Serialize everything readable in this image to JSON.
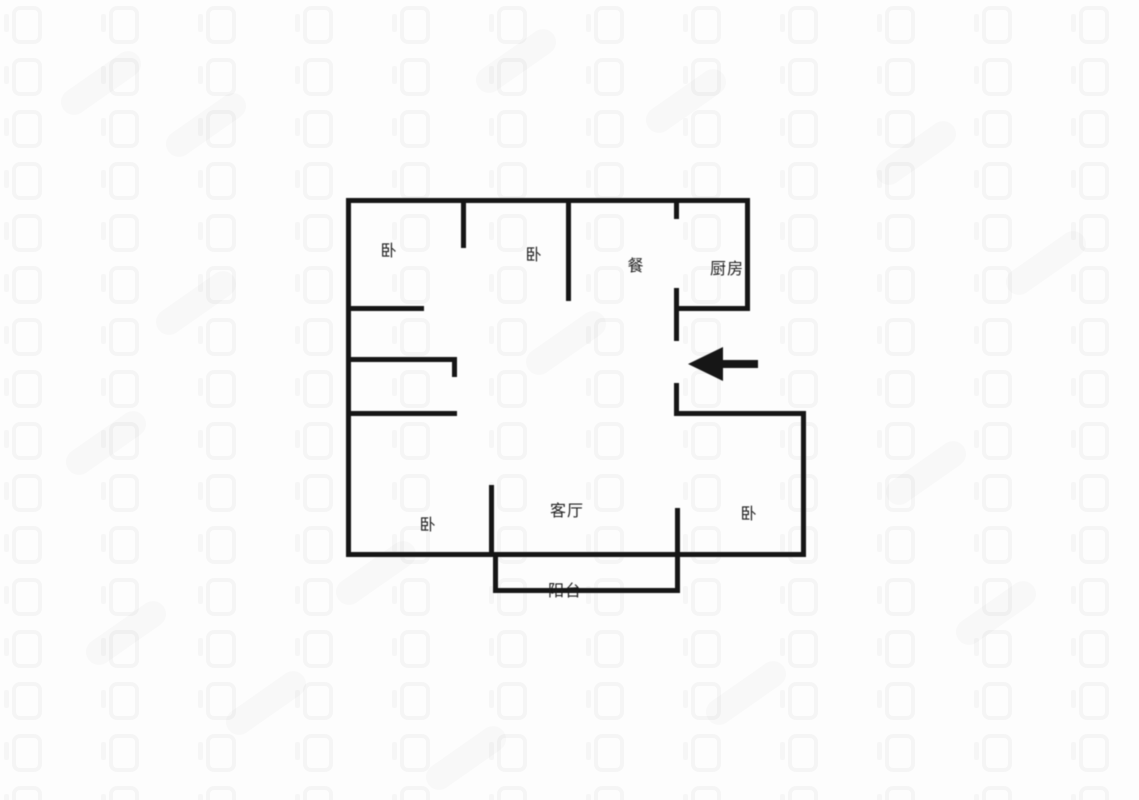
{
  "floorplan": {
    "wall_color": "#161616",
    "rooms": [
      {
        "name": "bedroom-1",
        "label": "卧",
        "x": 389,
        "y": 249
      },
      {
        "name": "bedroom-2",
        "label": "卧",
        "x": 534,
        "y": 253
      },
      {
        "name": "dining",
        "label": "餐",
        "x": 636,
        "y": 264
      },
      {
        "name": "kitchen",
        "label": "厨房",
        "x": 727,
        "y": 267
      },
      {
        "name": "bedroom-3",
        "label": "卧",
        "x": 428,
        "y": 523
      },
      {
        "name": "living-room",
        "label": "客厅",
        "x": 567,
        "y": 509
      },
      {
        "name": "bedroom-4",
        "label": "卧",
        "x": 749,
        "y": 512
      },
      {
        "name": "balcony",
        "label": "阳台",
        "x": 565,
        "y": 589
      }
    ],
    "walls": [
      {
        "name": "outer-top",
        "x": 346,
        "y": 198,
        "w": 404,
        "h": 5
      },
      {
        "name": "outer-left",
        "x": 346,
        "y": 198,
        "w": 5,
        "h": 359
      },
      {
        "name": "outer-bottom",
        "x": 346,
        "y": 552,
        "w": 460,
        "h": 5
      },
      {
        "name": "outer-right-lower",
        "x": 801,
        "y": 411,
        "w": 5,
        "h": 146
      },
      {
        "name": "bedroom-4-top",
        "x": 674,
        "y": 411,
        "w": 132,
        "h": 5
      },
      {
        "name": "outer-right-upper",
        "x": 745,
        "y": 198,
        "w": 5,
        "h": 113
      },
      {
        "name": "kitchen-bottom",
        "x": 674,
        "y": 306,
        "w": 76,
        "h": 5
      },
      {
        "name": "kitchen-left-stub",
        "x": 674,
        "y": 198,
        "w": 5,
        "h": 21
      },
      {
        "name": "kitchen-left-mid",
        "x": 674,
        "y": 288,
        "w": 5,
        "h": 53
      },
      {
        "name": "entry-side",
        "x": 674,
        "y": 383,
        "w": 5,
        "h": 33
      },
      {
        "name": "bed1-bed2-partition",
        "x": 461,
        "y": 198,
        "w": 5,
        "h": 50
      },
      {
        "name": "bed2-dining-partition",
        "x": 566,
        "y": 198,
        "w": 5,
        "h": 103
      },
      {
        "name": "bed1-bottom",
        "x": 346,
        "y": 306,
        "w": 78,
        "h": 5
      },
      {
        "name": "hall-upper",
        "x": 346,
        "y": 357,
        "w": 111,
        "h": 5
      },
      {
        "name": "hall-stub",
        "x": 452,
        "y": 357,
        "w": 5,
        "h": 20
      },
      {
        "name": "hall-lower",
        "x": 346,
        "y": 411,
        "w": 111,
        "h": 5
      },
      {
        "name": "bed3-living-partition",
        "x": 489,
        "y": 485,
        "w": 5,
        "h": 72
      },
      {
        "name": "living-bed4-partition",
        "x": 675,
        "y": 508,
        "w": 5,
        "h": 85
      },
      {
        "name": "balcony-left",
        "x": 493,
        "y": 552,
        "w": 5,
        "h": 41
      },
      {
        "name": "balcony-bottom",
        "x": 493,
        "y": 588,
        "w": 186,
        "h": 5
      }
    ],
    "entrance_arrow": {
      "direction": "left",
      "points": "688,364 723,347 723,360 758,360 758,368 723,368 723,381"
    }
  },
  "watermark": {
    "glyph_color": "rgba(0,0,0,0.03)"
  }
}
